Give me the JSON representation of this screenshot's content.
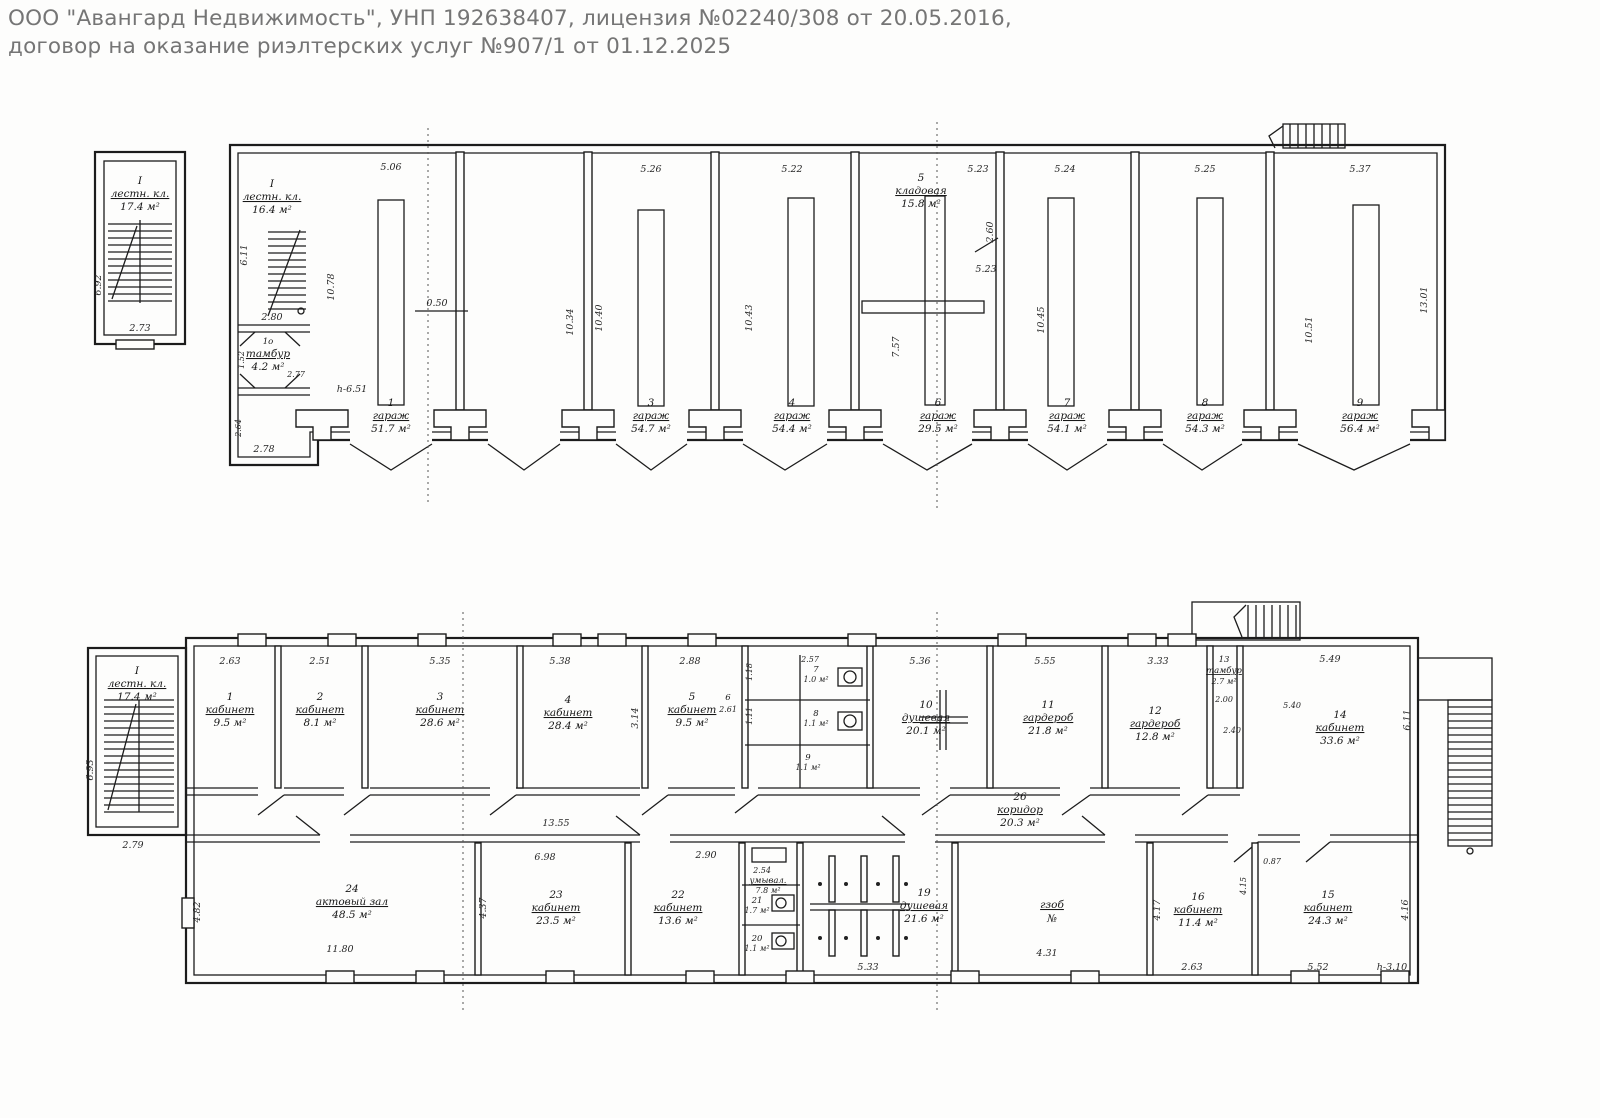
{
  "header": {
    "line1": "ООО \"Авангард Недвижимость\", УНП 192638407, лицензия №02240/308 от 20.05.2016,",
    "line2": "договор на оказание риэлтерских услуг №907/1 от 01.12.2025"
  },
  "upper": {
    "stair_block": {
      "number": "I",
      "name": "лестн. кл.",
      "area": "17.4 м²"
    },
    "annex_stair": {
      "number": "I",
      "name": "лестн. кл.",
      "area": "16.4 м²"
    },
    "tambour": {
      "number": "1о",
      "name": "тамбур",
      "area": "4.2 м²"
    },
    "rooms": {
      "g1": {
        "number": "1",
        "name": "гараж",
        "area": "51.7 м²"
      },
      "g3": {
        "number": "3",
        "name": "гараж",
        "area": "54.7 м²"
      },
      "g4": {
        "number": "4",
        "name": "гараж",
        "area": "54.4 м²"
      },
      "k5": {
        "number": "5",
        "name": "кладовая",
        "area": "15.8 м²"
      },
      "g6": {
        "number": "6",
        "name": "гараж",
        "area": "29.5 м²"
      },
      "g7": {
        "number": "7",
        "name": "гараж",
        "area": "54.1 м²"
      },
      "g8": {
        "number": "8",
        "name": "гараж",
        "area": "54.3 м²"
      },
      "g9": {
        "number": "9",
        "name": "гараж",
        "area": "56.4 м²"
      }
    },
    "dims": {
      "bay1_w": "5.06",
      "bay3_w": "5.26",
      "bay4_w": "5.22",
      "bay5_w": "5.23",
      "bay7_w": "5.24",
      "bay8_w": "5.25",
      "bay9_w": "5.37",
      "annex_h": "6.11",
      "bay1_h": "10.78",
      "pit": "0.50",
      "bay2_h": "10.34",
      "bay3_h": "10.40",
      "bay4_h": "10.43",
      "bay5_h": "7.57",
      "bay7_h": "10.45",
      "bay9_h": "10.51",
      "right_h": "13.01",
      "store_h": "2.60",
      "store_door": "5.23",
      "annex_w": "2.80",
      "tambour_wd": "2.77",
      "tambour_h": "1.52",
      "annex_b": "2.78",
      "annex_bh": "2.64",
      "stair_w": "2.73",
      "stair_h": "6.92",
      "ceil": "h-6.51"
    }
  },
  "lower": {
    "stair_block": {
      "number": "I",
      "name": "лестн. кл.",
      "area": "17.4 м²"
    },
    "rooms": {
      "r1": {
        "number": "1",
        "name": "кабинет",
        "area": "9.5 м²"
      },
      "r2": {
        "number": "2",
        "name": "кабинет",
        "area": "8.1 м²"
      },
      "r3": {
        "number": "3",
        "name": "кабинет",
        "area": "28.6 м²"
      },
      "r4": {
        "number": "4",
        "name": "кабинет",
        "area": "28.4 м²"
      },
      "r5": {
        "number": "5",
        "name": "кабинет",
        "area": "9.5 м²"
      },
      "r6": {
        "number": "6"
      },
      "r7": {
        "number": "7",
        "area": "1.0 м²"
      },
      "r8": {
        "number": "8",
        "area": "1.1 м²"
      },
      "r9": {
        "number": "9",
        "area": "1.1 м²"
      },
      "r10": {
        "number": "10",
        "name": "душевая",
        "area": "20.1 м²"
      },
      "r11": {
        "number": "11",
        "name": "гардероб",
        "area": "21.8 м²"
      },
      "r12": {
        "number": "12",
        "name": "гардероб",
        "area": "12.8 м²"
      },
      "r13": {
        "number": "13",
        "name": "тамбур",
        "area": "2.7 м²"
      },
      "r14": {
        "number": "14",
        "name": "кабинет",
        "area": "33.6 м²"
      },
      "r15": {
        "number": "15",
        "name": "кабинет",
        "area": "24.3 м²"
      },
      "r16": {
        "number": "16",
        "name": "кабинет",
        "area": "11.4 м²"
      },
      "r17": {
        "name": "гзоб",
        "area": "№"
      },
      "r19": {
        "number": "19",
        "name": "душевая",
        "area": "21.6 м²"
      },
      "r20": {
        "number": "20",
        "area": "1.1 м²"
      },
      "r21": {
        "number": "21",
        "area": "1.7 м²"
      },
      "r22": {
        "number": "22",
        "name": "кабинет",
        "area": "13.6 м²"
      },
      "r23": {
        "number": "23",
        "name": "кабинет",
        "area": "23.5 м²"
      },
      "r24": {
        "number": "24",
        "name": "актовый зал",
        "area": "48.5 м²"
      },
      "r25": {
        "name": "умывал.",
        "area": "7.8 м²"
      },
      "r26": {
        "number": "26",
        "name": "коридор",
        "area": "20.3 м²"
      }
    },
    "dims": {
      "r1_w": "2.63",
      "r2_w": "2.51",
      "r3_w": "5.35",
      "r4_w": "5.38",
      "r5_w": "2.88",
      "wc_w": "2.57",
      "r10_w": "5.36",
      "r11_w": "5.55",
      "r12_w": "3.33",
      "r14_w": "5.49",
      "r14_h": "6.11",
      "r45": "3.14",
      "stair_w": "2.79",
      "stair_h": "6.93",
      "hall_h": "4.82",
      "corr": "13.55",
      "r23_w": "6.98",
      "r22_w": "2.90",
      "hall_b": "11.80",
      "r23_h": "4.37",
      "r19_w": "5.33",
      "r17_w": "4.31",
      "r16_h": "4.17",
      "r16_w": "2.63",
      "r15_w": "5.52",
      "r15_h": "4.16",
      "ceil": "h-3.10",
      "t13_a": "2.00",
      "t13_b": "2.40",
      "wash": "2.54",
      "r6": "2.61",
      "p087": "0.87",
      "p415": "4.15",
      "p540": "5.40",
      "wc7_h": "1.18",
      "wc8_h": "1.11"
    }
  }
}
